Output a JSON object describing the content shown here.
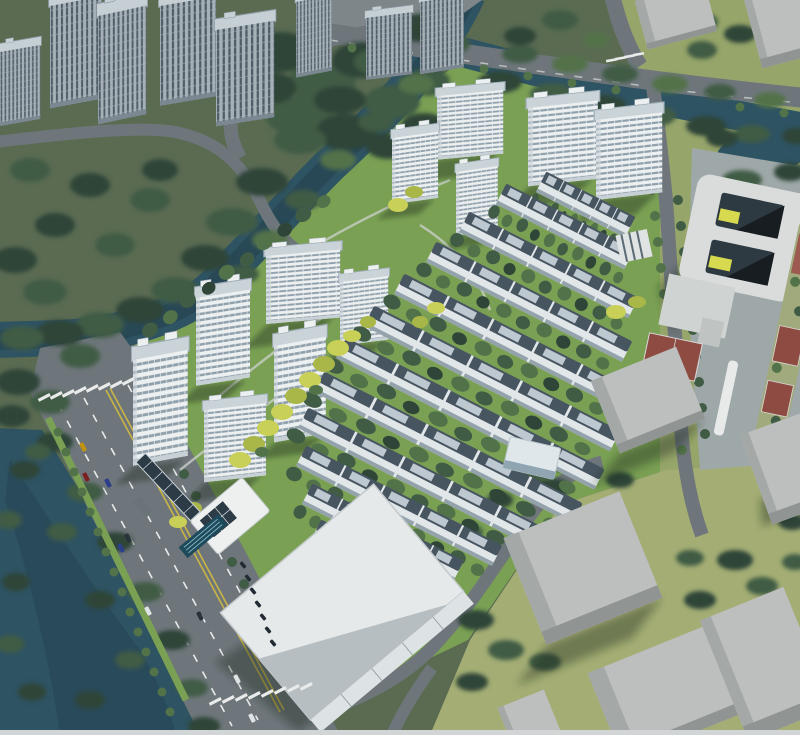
{
  "meta": {
    "title": "Aerial rendering of riverside residential development",
    "description": "Bird's-eye masterplan rendering: white high-rise apartment towers and diagonal rows of townhouses with dark roofs set in green landscaping with yellow accent trees, bounded by a tree-lined canal and river, a wide arterial road with crosswalks and cars at lower left, a school block with red sports courts at right, plain grey context massing blocks, a large white-roofed warehouse building, a solar canopy, clubhouse and lap pool at the entrance.",
    "canvas": {
      "width": 800,
      "height": 735
    }
  },
  "palette": {
    "waterDark": "#24414f",
    "water": "#2e5363",
    "waterLight": "#3d6375",
    "groundBase": "#5a6b52",
    "groundDev": "#7aa054",
    "groundYellow": "#96a56a",
    "groundYellow2": "#a3ad74",
    "road": "#6e767b",
    "roadLight": "#7e868a",
    "roadDark": "#5c6368",
    "marking": "#e9ebea",
    "markingYellow": "#c9b545",
    "towerWall": "#edf0f1",
    "towerWallShade": "#c6d0d5",
    "towerStripe": "#8fa0ab",
    "towerRoof": "#c9d3d8",
    "towerRoofEdge": "#9dabb4",
    "ctxWall": "#a6b0b7",
    "ctxStripe": "#4f5d67",
    "ctxRoof": "#c6cfd4",
    "rowRoof": "#475560",
    "rowPanel": "#c9d3da",
    "rowWall": "#e1e6e9",
    "rowWallShade": "#94a2ab",
    "massTop": "#bcbfbe",
    "massSide": "#a4a8a7",
    "massFront": "#909493",
    "schoolWall": "#d9dcdb",
    "schoolCourt": "#2e3a41",
    "accentYellow": "#d7d94f",
    "courtRed": "#8e4b42",
    "trackBase": "#a0aa7c",
    "panelDark": "#2c3b45",
    "poolBlue": "#1e4a5c",
    "poolLane": "#8fc3d0",
    "treeDark": "#2f4538",
    "treeMid": "#405c45",
    "treeGreen": "#52724a",
    "treeLight": "#648455",
    "treeYellow": "#c9d058",
    "treeYellowDark": "#a9b648",
    "pathLight": "#ccd2cd",
    "bottomStrip": "#d2d5d6"
  },
  "scene": {
    "counts": {
      "development_towers": 11,
      "townhouse_rows": 11,
      "context_towers_top_left": 8,
      "context_massing_blocks": 8,
      "crosswalks": 3,
      "red_sports_courts": 3
    },
    "features": [
      "canal",
      "river",
      "arterial-road",
      "lane-markings",
      "cars",
      "crosswalks",
      "yellow-accent-trees",
      "solar-canopy",
      "clubhouse",
      "swimming-pool",
      "warehouse-building",
      "school-courtyard-building",
      "basketball-court",
      "tennis-courts",
      "street-trees"
    ]
  }
}
